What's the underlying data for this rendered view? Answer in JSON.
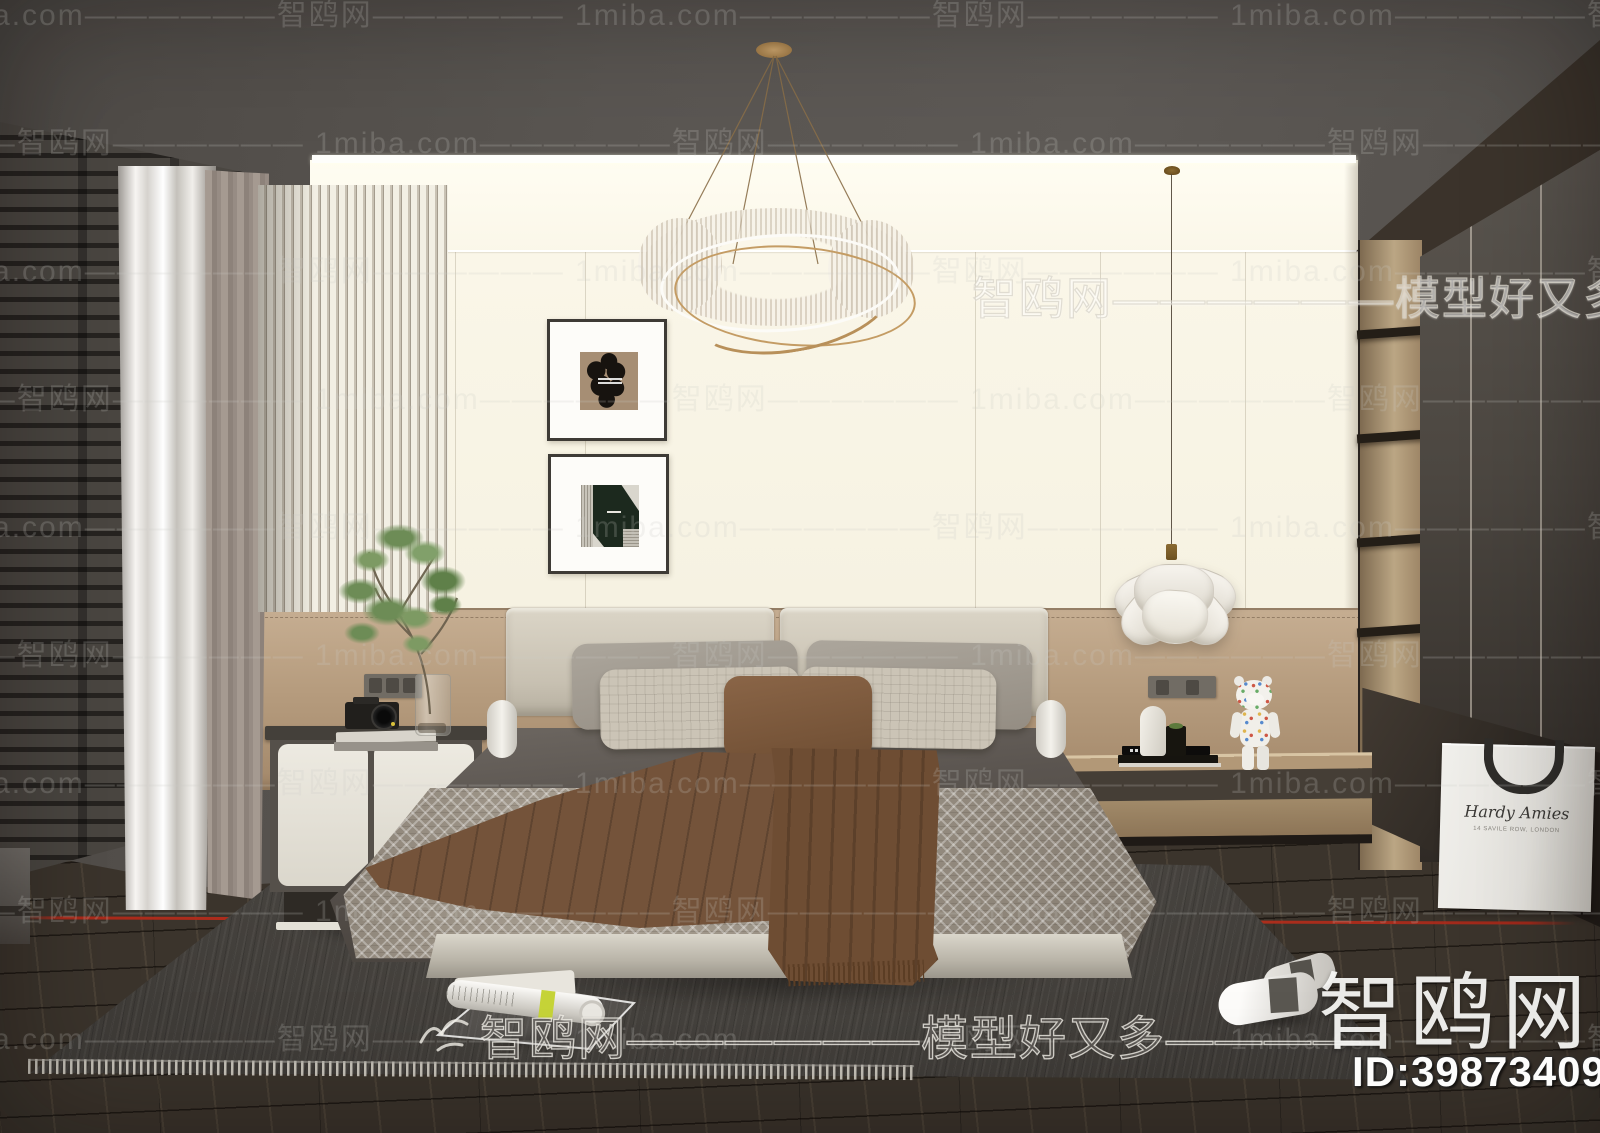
{
  "watermarks": {
    "tile_text": "1miba.com——————智鸥网——————",
    "slogan_text": "智鸥网——————模型好又多————",
    "brand_logo": "智鸥网",
    "model_id": "ID:398734098",
    "bird_icon": "seagull"
  },
  "shopping_bag": {
    "brand_script": "Hardy Amies",
    "address_line": "14 SAVILE ROW, LONDON"
  },
  "palette": {
    "ceiling": "#57534f",
    "wall_cream": "#faf6e8",
    "wood_band": "#b69c7e",
    "wardrobe_door": "#4c4741",
    "carpet": "#514d48",
    "floor": "#3b342c",
    "duvet": "#57514c",
    "bedspread": "#a79e91",
    "throw_brown": "#75533a",
    "accent_red": "#af2a1a",
    "curtain_sheer": "#f1efeb",
    "pendant_shade": "#efece4"
  }
}
